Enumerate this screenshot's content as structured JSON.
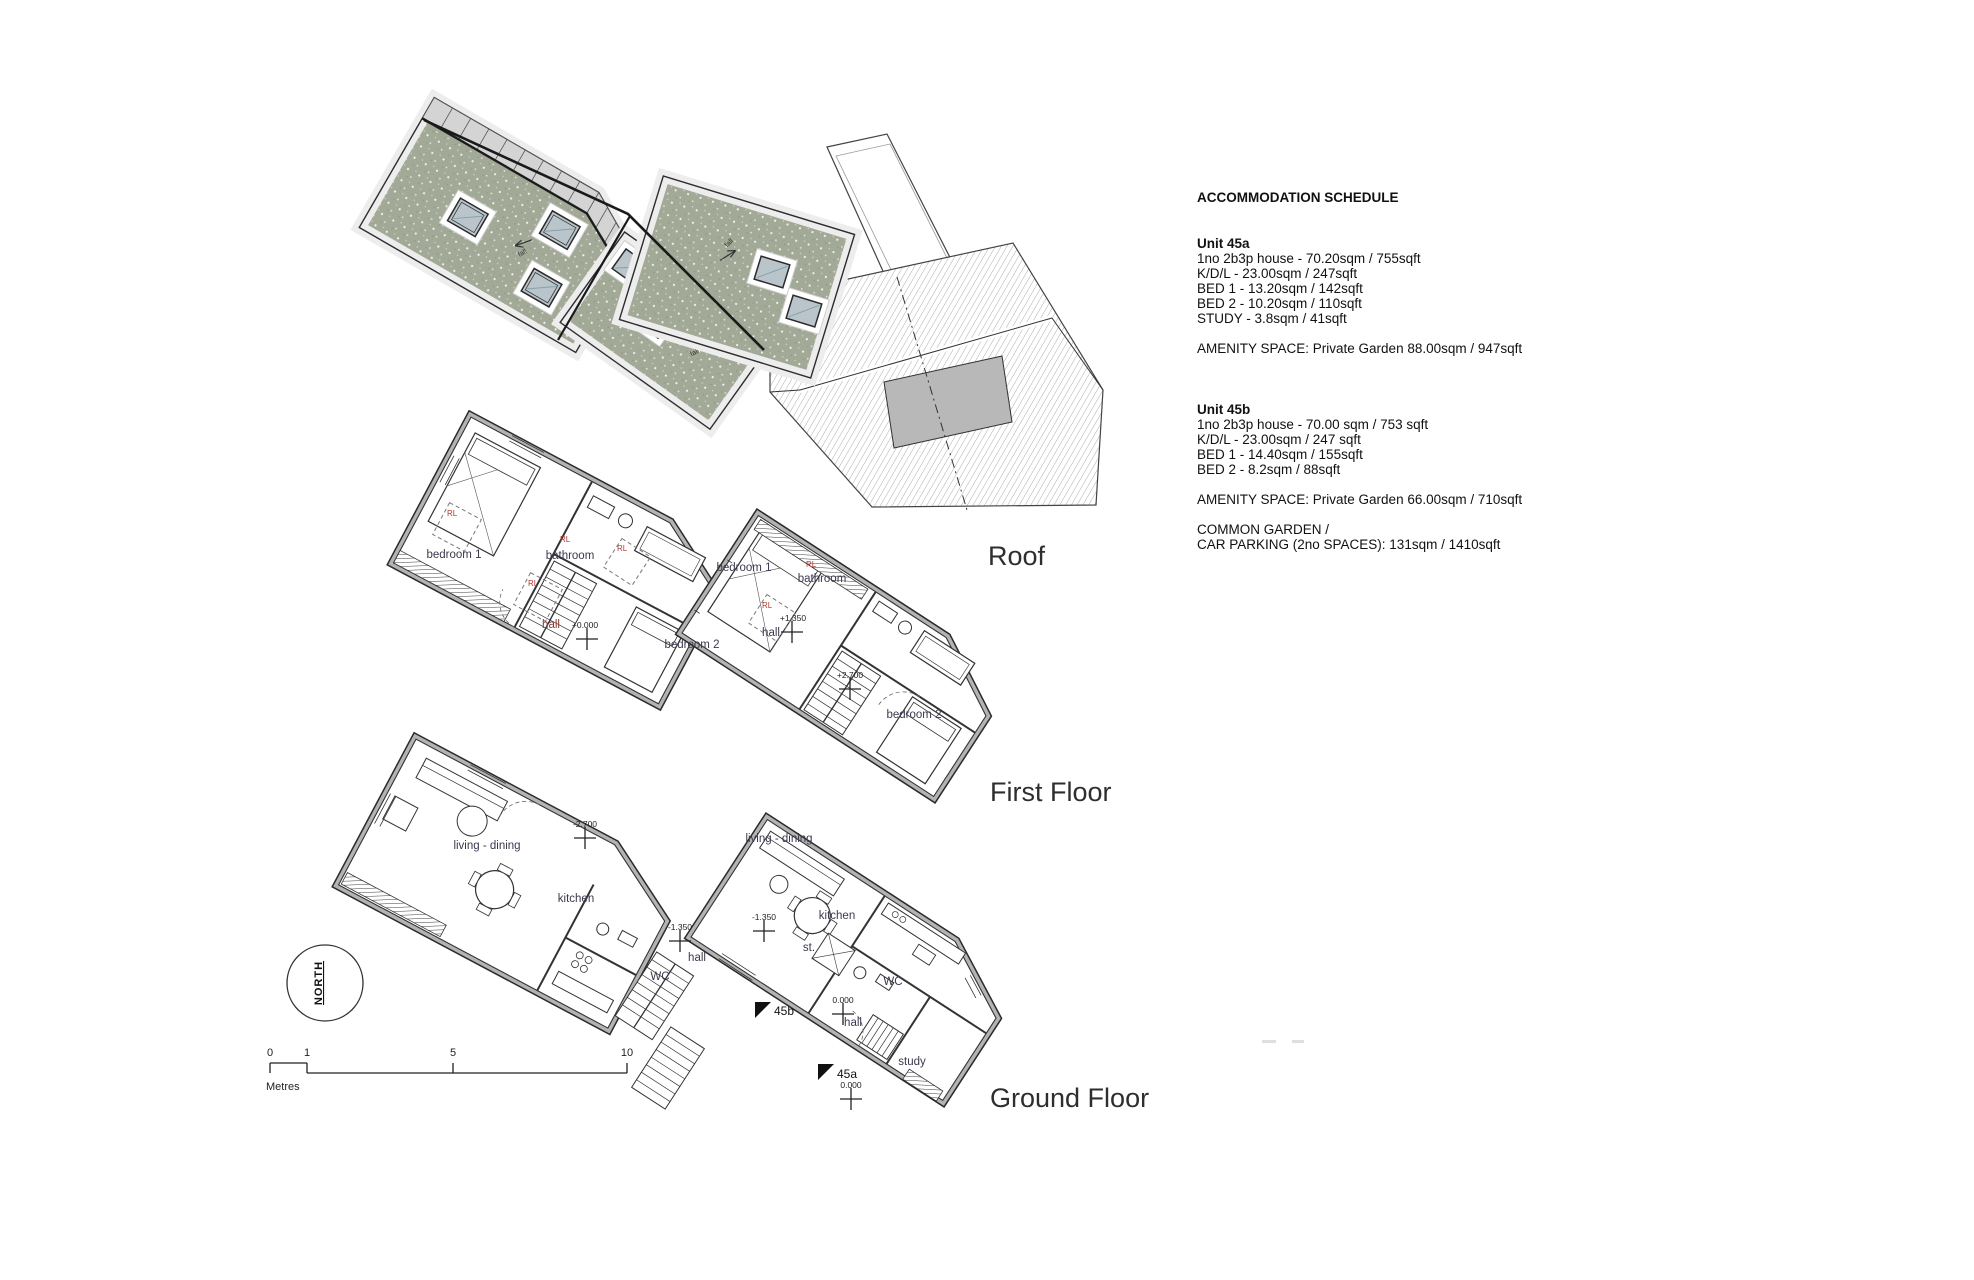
{
  "titles": {
    "roof": "Roof",
    "first_floor": "First Floor",
    "ground_floor": "Ground Floor"
  },
  "schedule": {
    "title": "ACCOMMODATION SCHEDULE",
    "unit_a": {
      "name": "Unit 45a",
      "line1": "1no 2b3p house - 70.20sqm / 755sqft",
      "line2": "K/D/L - 23.00sqm / 247sqft",
      "line3": "BED 1 - 13.20sqm / 142sqft",
      "line4": "BED 2 -  10.20sqm / 110sqft",
      "line5": "STUDY -  3.8sqm / 41sqft",
      "amenity": "AMENITY SPACE: Private Garden 88.00sqm / 947sqft"
    },
    "unit_b": {
      "name": "Unit 45b",
      "line1": "1no 2b3p house - 70.00 sqm / 753 sqft",
      "line2": "K/D/L - 23.00sqm / 247 sqft",
      "line3": "BED 1 - 14.40sqm / 155sqft",
      "line4": "BED 2 - 8.2sqm / 88sqft",
      "amenity": "AMENITY SPACE: Private Garden 66.00sqm / 710sqft",
      "common1": "COMMON GARDEN /",
      "common2": "CAR PARKING (2no SPACES):  131sqm / 1410sqft"
    }
  },
  "rooms": {
    "ff_left": {
      "bedroom1": "bedroom 1",
      "bathroom": "bathroom",
      "hall": "hall",
      "bedroom2": "bedroom 2"
    },
    "ff_right": {
      "bedroom1": "bedroom 1",
      "bathroom": "bathroom",
      "hall": "hall",
      "bedroom2": "bedroom 2"
    },
    "gf_left": {
      "living": "living - dining",
      "kitchen": "kitchen",
      "wc": "WC",
      "hall": "hall"
    },
    "gf_right": {
      "living": "living - dining",
      "kitchen": "kitchen",
      "wc": "WC",
      "hall": "hall",
      "study": "study",
      "store": "st."
    }
  },
  "levels": {
    "ff_left": "+0.000",
    "ff_right_a": "+1.350",
    "ff_right_b": "+2.700",
    "gf_left_a": "-2.700",
    "gf_left_b": "-1.350",
    "gf_right_a": "-1.350",
    "gf_right_b": "0.000",
    "gf_right_c": "0.000"
  },
  "annotations": {
    "rl": "RL",
    "fall": "fall",
    "north": "NORTH",
    "entry_a": "45a",
    "entry_b": "45b"
  },
  "scalebar": {
    "t0": "0",
    "t1": "1",
    "t5": "5",
    "t10": "10",
    "unit": "Metres"
  },
  "colors": {
    "green_roof": "#a2a996",
    "skylight": "#b9c5cb",
    "wall_grey": "#b3b3b3",
    "dormer_grey": "#b8b8b8",
    "label_ink": "#3a3a4e",
    "red_note": "#b03a2e"
  }
}
